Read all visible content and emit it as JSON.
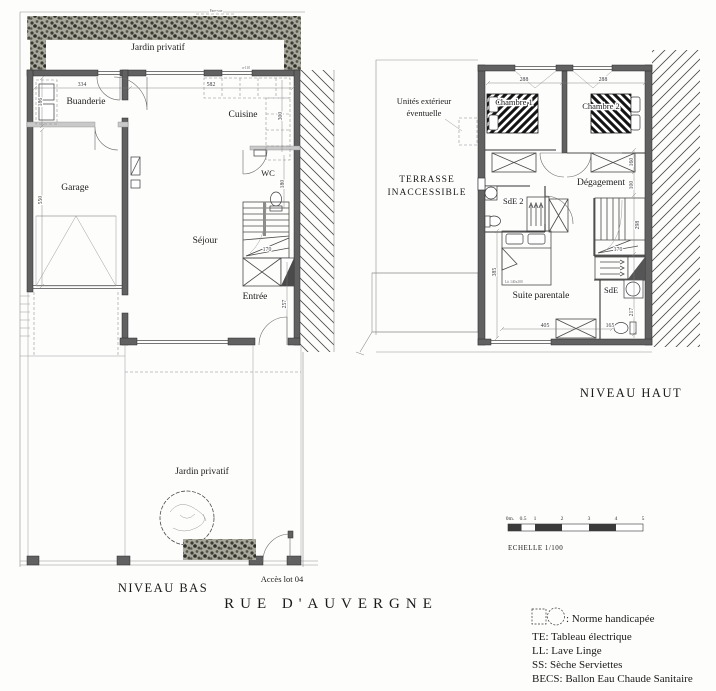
{
  "page": {
    "title": "RUE D'AUVERGNE"
  },
  "niveau_bas": {
    "label": "NIVEAU BAS",
    "jardin_top": "Jardin privatif",
    "jardin_bottom": "Jardin privatif",
    "fence_label": "Pare-vue",
    "acces": "Accès lot 04",
    "window_label": "a-110",
    "rooms": {
      "buanderie": "Buanderie",
      "garage": "Garage",
      "cuisine": "Cuisine",
      "wc": "WC",
      "sejour": "Séjour",
      "entree": "Entrée"
    },
    "dims": {
      "buanderie_w": "334",
      "buanderie_h": "186",
      "cuisine_w": "582",
      "cuisine_depth": "300",
      "garage_h": "550",
      "wc_h": "180",
      "stair_w": "170",
      "entree_h": "257"
    }
  },
  "niveau_haut": {
    "label": "NIVEAU HAUT",
    "terrasse_line1": "TERRASSE",
    "terrasse_line2": "INACCESSIBLE",
    "unites_line1": "Unités extérieur",
    "unites_line2": "éventuelle",
    "bed_label": "Lit 140x200",
    "rooms": {
      "chambre1": "Chambre 1",
      "chambre2": "Chambre 2",
      "degagement": "Dégagement",
      "sde2": "SdE 2",
      "sde": "SdE",
      "suite": "Suite parentale"
    },
    "dims": {
      "ch1_w": "288",
      "ch2_w": "288",
      "wardrobe_l": "160",
      "couloir_w": "100",
      "stair_h": "298",
      "stair_w": "170",
      "suite_h": "385",
      "suite_w": "405",
      "sde_h": "217",
      "sde_w": "165"
    }
  },
  "scalebar": {
    "label": "ECHELLE 1/100",
    "ticks": [
      "0m.",
      "0.5",
      "1",
      "2",
      "3",
      "4",
      "5"
    ]
  },
  "legend": {
    "norme": ": Norme handicapée",
    "te": "TE: Tableau électrique",
    "ll": "LL: Lave Linge",
    "ss": "SS: Sèche Serviettes",
    "becs": "BECS: Ballon Eau Chaude Sanitaire"
  }
}
